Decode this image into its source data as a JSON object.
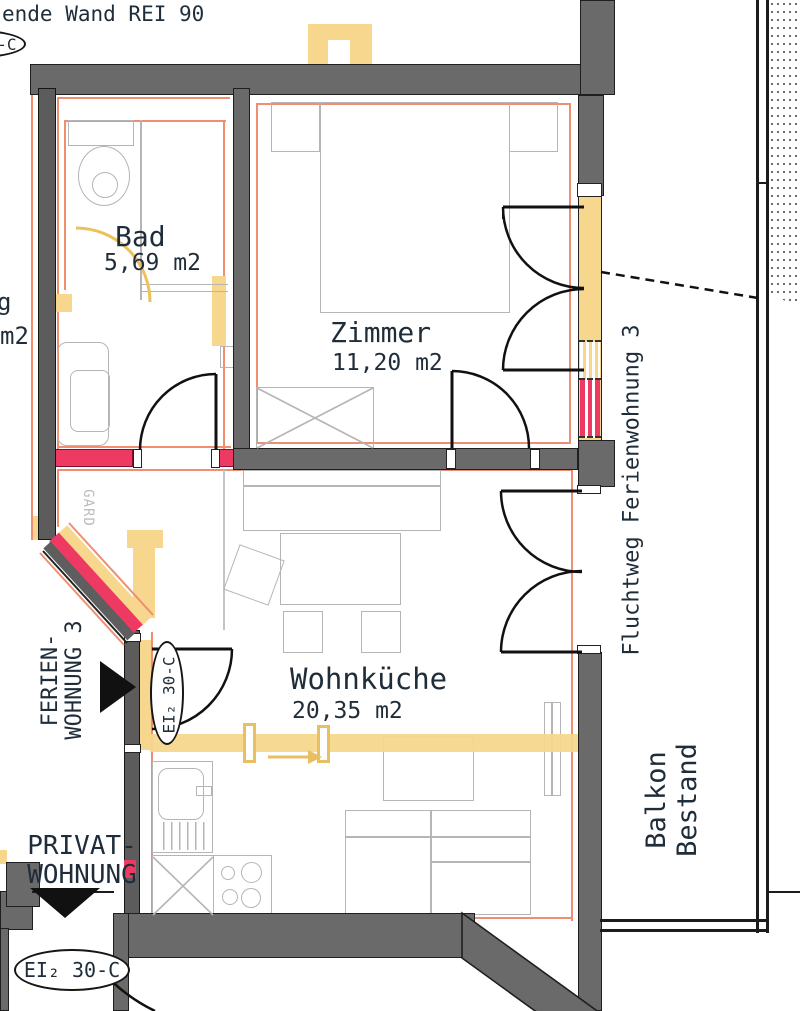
{
  "colors": {
    "wall_gray": "#6a6a6a",
    "fire_pink": "#ee3a63",
    "escape_yellow": "#f6d78d",
    "rei_orange": "#ef8e70",
    "furniture_gray": "#b5b5b5",
    "text_dark": "#1f2d3a"
  },
  "notes": {
    "top_wall_note": "ende Wand REI 90",
    "gard": "GARD",
    "partial_room_label_line1": "g",
    "partial_room_label_line2": "m2"
  },
  "rooms": {
    "bad": {
      "name": "Bad",
      "area": "5,69 m2"
    },
    "zimmer": {
      "name": "Zimmer",
      "area": "11,20 m2"
    },
    "wohnkueche": {
      "name": "Wohnküche",
      "area": "20,35 m2"
    }
  },
  "annotations": {
    "fluchtweg": "Fluchtweg Ferienwohnung 3",
    "balkon_line1": "Balkon",
    "balkon_line2": "Bestand",
    "ferien_line1": "FERIEN-",
    "ferien_line2": "WOHNUNG 3",
    "privat_line1": "PRIVAT-",
    "privat_line2": "WOHNUNG",
    "fire_rating_label": "EI₂ 30-C"
  }
}
